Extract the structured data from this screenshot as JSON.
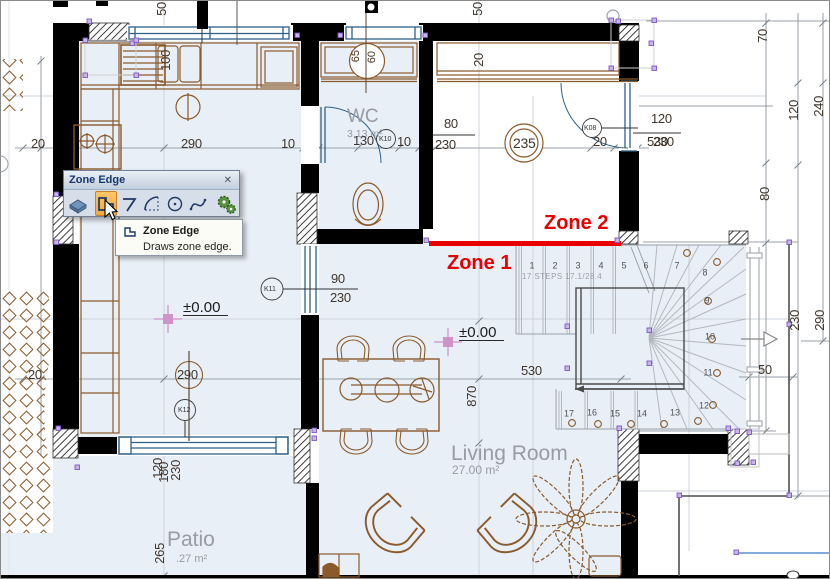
{
  "palette": {
    "title": "Zone Edge",
    "close_label": "✕",
    "tooltip": {
      "title": "Zone Edge",
      "description": "Draws zone edge."
    }
  },
  "zones": {
    "zone1": "Zone 1",
    "zone2": "Zone 2",
    "color": "#e60000"
  },
  "rooms": {
    "wc": {
      "name": "WC",
      "area": "3.13 m²"
    },
    "living": {
      "name": "Living Room",
      "area": "27.00 m²"
    },
    "patio": {
      "name": "Patio",
      "area": ".27 m²"
    }
  },
  "levels": {
    "left": "±0.00",
    "right": "±0.00"
  },
  "stair": {
    "note": "17 STEPS 17.1/28.4",
    "steps": [
      "1",
      "2",
      "3",
      "4",
      "5",
      "6",
      "7",
      "8",
      "9",
      "10",
      "11",
      "12",
      "13",
      "14",
      "15",
      "16",
      "17"
    ]
  },
  "markers": {
    "k10": "K10",
    "k11": "K11",
    "k12": "K12",
    "k08": "K08",
    "column": "235",
    "window_top": {
      "w": "65",
      "h": "60"
    }
  },
  "dims": {
    "top20": "20",
    "kitchen290": "290",
    "kitchen10": "10",
    "kitchen100": "100",
    "wc130": "130",
    "wc10": "10",
    "door80": "80",
    "door80h": "230",
    "hall20": "20",
    "k08_20": "20",
    "tr120": "120",
    "tr530": "530",
    "tr230": "230",
    "k11_90": "90",
    "k11_230": "230",
    "lr530": "530",
    "lr870": "870",
    "left290": "290",
    "left20": "20",
    "top50a": "50",
    "top50b": "50",
    "r70": "70",
    "r120": "120",
    "r240": "240",
    "r80": "80",
    "r230": "230",
    "r290": "290",
    "r50": "50",
    "p120": "120",
    "p180": "180",
    "p230": "230",
    "p265": "265"
  }
}
